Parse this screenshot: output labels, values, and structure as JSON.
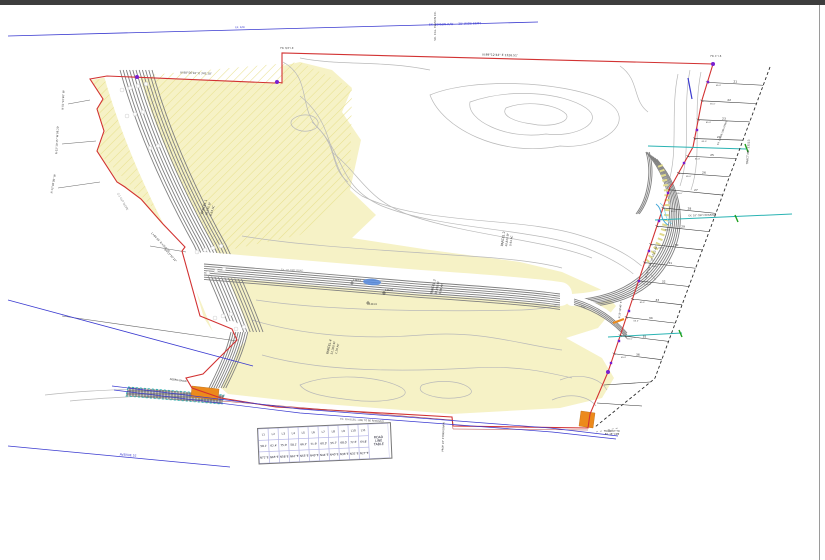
{
  "page": {
    "background": "#ffffff",
    "topbar_color": "#3d3d3d",
    "edge_color": "#9a9a9a"
  },
  "colors": {
    "boundary_red": "#d23232",
    "easement_blue": "#3a3ad0",
    "utility_teal": "#2ab3b3",
    "structure_orange": "#ec8a1c",
    "parcel_yellow": "#f6f2c6",
    "monument_purple": "#7a1fd0",
    "contour_gray": "#b9b9b9",
    "slope_gray": "#808080"
  },
  "labels": [
    {
      "text": "EX. EDISON R/W — 30' WIDE ESMT",
      "x": 455,
      "y": 25,
      "rot": -1.5,
      "size": 3,
      "color": "#3a3ad0"
    },
    {
      "text": "EX. R/W",
      "x": 240,
      "y": 28,
      "rot": -1.5,
      "size": 2.4,
      "color": "#3a3ad0"
    },
    {
      "text": "SO. CAL. EDISON CO.",
      "x": 436,
      "y": 26,
      "rot": -90,
      "size": 2.8,
      "color": "#555555"
    },
    {
      "text": "N 89°12'44\" E  1326.51'",
      "x": 500,
      "y": 56,
      "rot": 1.4,
      "size": 3,
      "color": "#333333"
    },
    {
      "text": "N 88°56'10\" E  342.10'",
      "x": 196,
      "y": 74,
      "rot": 2,
      "size": 2.8,
      "color": "#333333"
    },
    {
      "text": "N 01°22'40\" W",
      "x": 64,
      "y": 100,
      "rot": -87,
      "size": 2.6,
      "color": "#333333"
    },
    {
      "text": "N 02°10'15\" W  98.20'",
      "x": 58,
      "y": 140,
      "rot": -87,
      "size": 2.6,
      "color": "#333333"
    },
    {
      "text": "N 12°40'00\" W",
      "x": 54,
      "y": 184,
      "rot": -80,
      "size": 2.6,
      "color": "#333333"
    },
    {
      "text": "L=84.55'  R=350.00'",
      "x": 160,
      "y": 243,
      "rot": 47,
      "size": 2.6,
      "color": "#333333"
    },
    {
      "text": "Δ=13°50'22\"",
      "x": 170,
      "y": 256,
      "rot": 47,
      "size": 2.6,
      "color": "#333333"
    },
    {
      "text": "2:1 CUT SLOPE",
      "x": 122,
      "y": 202,
      "rot": 60,
      "size": 2.6,
      "color": "#777777"
    },
    {
      "text": "PARCEL 1",
      "x": 205,
      "y": 207,
      "rot": -73,
      "size": 3.2,
      "color": "#333333"
    },
    {
      "text": "36,155 SF",
      "x": 209,
      "y": 209,
      "rot": -73,
      "size": 2.7,
      "color": "#333333"
    },
    {
      "text": "0.83 AC",
      "x": 213,
      "y": 211,
      "rot": -73,
      "size": 2.7,
      "color": "#333333"
    },
    {
      "text": "PARCEL 2",
      "x": 504,
      "y": 239,
      "rot": -82,
      "size": 3.2,
      "color": "#333333"
    },
    {
      "text": "40,820 SF",
      "x": 508,
      "y": 240,
      "rot": -82,
      "size": 2.7,
      "color": "#333333"
    },
    {
      "text": "0.94 AC",
      "x": 512,
      "y": 241,
      "rot": -82,
      "size": 2.7,
      "color": "#333333"
    },
    {
      "text": "PARCEL 3",
      "x": 434,
      "y": 287,
      "rot": -77,
      "size": 3.2,
      "color": "#333333"
    },
    {
      "text": "38,450 SF",
      "x": 438,
      "y": 288,
      "rot": -77,
      "size": 2.7,
      "color": "#333333"
    },
    {
      "text": "0.88 AC",
      "x": 442,
      "y": 289,
      "rot": -77,
      "size": 2.7,
      "color": "#333333"
    },
    {
      "text": "PARCEL 4",
      "x": 330,
      "y": 347,
      "rot": -77,
      "size": 3.2,
      "color": "#333333"
    },
    {
      "text": "52,300 SF",
      "x": 334,
      "y": 348,
      "rot": -77,
      "size": 2.7,
      "color": "#333333"
    },
    {
      "text": "1.20 AC",
      "x": 338,
      "y": 349,
      "rot": -77,
      "size": 2.7,
      "color": "#333333"
    },
    {
      "text": "EX. 10' DIRT ROAD",
      "x": 292,
      "y": 271,
      "rot": 2.5,
      "size": 2.4,
      "color": "#888888"
    },
    {
      "text": "TRACT NO. 23113",
      "x": 749,
      "y": 152,
      "rot": -86,
      "size": 2.8,
      "color": "#333333"
    },
    {
      "text": "N 35°18'40\" E",
      "x": 621,
      "y": 310,
      "rot": -84,
      "size": 2.4,
      "color": "#333333"
    },
    {
      "text": "PROP. 24\" STORM DRAIN",
      "x": 444,
      "y": 437,
      "rot": -88,
      "size": 2.4,
      "color": "#333333"
    },
    {
      "text": "EX. O/H ELEC. LINE TO BE REMOVED",
      "x": 362,
      "y": 421,
      "rot": 3.2,
      "size": 2.4,
      "color": "#555555"
    },
    {
      "text": "AVENUE 52",
      "x": 128,
      "y": 456,
      "rot": 4.5,
      "size": 3,
      "color": "#3a3ad0"
    },
    {
      "text": "CONNECT TO",
      "x": 612,
      "y": 432,
      "rot": 0,
      "size": 2.3,
      "color": "#333333"
    },
    {
      "text": "EX. 18\" CMP",
      "x": 612,
      "y": 435,
      "rot": 0,
      "size": 2.3,
      "color": "#333333"
    },
    {
      "text": "DEBRIS BASIN",
      "x": 178,
      "y": 381,
      "rot": 8,
      "size": 2.4,
      "color": "#333333"
    },
    {
      "text": "N 18°24'36\" W  1012.44'",
      "x": 652,
      "y": 262,
      "rot": -71,
      "size": 2.8,
      "color": "#333333"
    },
    {
      "text": "FD. 1\" I.P.",
      "x": 716,
      "y": 57,
      "rot": 0,
      "size": 2.3,
      "color": "#333333"
    },
    {
      "text": "FD. 3/4\" I.P.",
      "x": 287,
      "y": 49,
      "rot": 0,
      "size": 2.3,
      "color": "#333333"
    },
    {
      "text": "EX. 18\" CMP CROSSING",
      "x": 702,
      "y": 216,
      "rot": -1.5,
      "size": 2.3,
      "color": "#333333"
    },
    {
      "text": "EX. CHAIN LINK FENCE",
      "x": 723,
      "y": 133,
      "rot": -70,
      "size": 2.3,
      "color": "#333333"
    },
    {
      "text": "1243.1",
      "x": 357,
      "y": 281,
      "rot": 0,
      "size": 2.2,
      "color": "#333333"
    },
    {
      "text": "1242.8",
      "x": 389,
      "y": 291,
      "rot": 0,
      "size": 2.2,
      "color": "#333333"
    },
    {
      "text": "1241.9",
      "x": 373,
      "y": 305,
      "rot": 0,
      "size": 2.2,
      "color": "#333333"
    }
  ],
  "lots": {
    "numbers": [
      "21",
      "22",
      "23",
      "24",
      "25",
      "26",
      "27",
      "28",
      "29",
      "30",
      "31",
      "32",
      "33",
      "34",
      "35",
      "36"
    ],
    "dim_note": "65.0'"
  },
  "line_table": {
    "title_lines": [
      "ROAD",
      "LINE",
      "TABLE"
    ],
    "columns": [
      {
        "id": "L1",
        "length": "58.1'",
        "bearing": "N72°E"
      },
      {
        "id": "L2",
        "length": "62.4'",
        "bearing": "N65°E"
      },
      {
        "id": "L3",
        "length": "75.0'",
        "bearing": "N58°E"
      },
      {
        "id": "L4",
        "length": "58.1'",
        "bearing": "N61°E"
      },
      {
        "id": "L5",
        "length": "66.2'",
        "bearing": "N55°E"
      },
      {
        "id": "L6",
        "length": "71.9'",
        "bearing": "N49°E"
      },
      {
        "id": "L7",
        "length": "60.3'",
        "bearing": "N44°E"
      },
      {
        "id": "L8",
        "length": "55.7'",
        "bearing": "N40°E"
      },
      {
        "id": "L9",
        "length": "68.0'",
        "bearing": "N36°E"
      },
      {
        "id": "L10",
        "length": "72.5'",
        "bearing": "N31°E"
      },
      {
        "id": "L11",
        "length": "64.8'",
        "bearing": "N27°E"
      }
    ]
  }
}
